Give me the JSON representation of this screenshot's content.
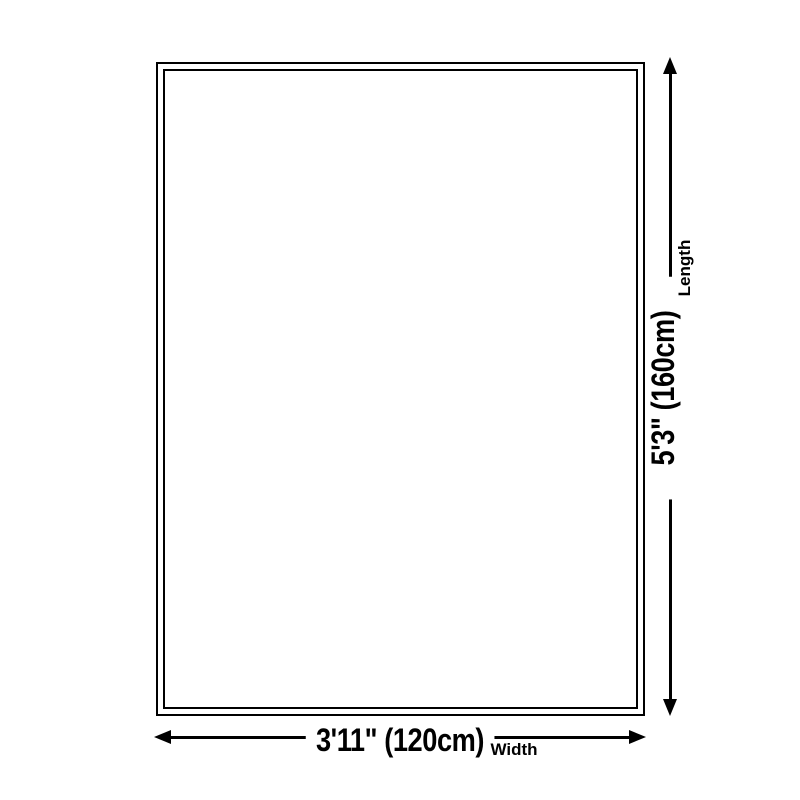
{
  "diagram": {
    "background_color": "#ffffff",
    "line_color": "#000000",
    "length": {
      "value": "5'3\" (160cm)",
      "label": "Length"
    },
    "width": {
      "value": "3'11\" (120cm)",
      "label": "Width"
    }
  }
}
